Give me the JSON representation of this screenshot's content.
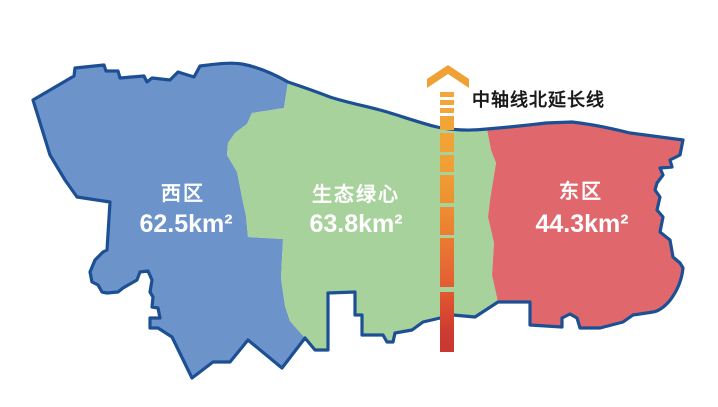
{
  "map": {
    "regions": [
      {
        "id": "west",
        "name": "西区",
        "area": "62.5km²",
        "color": "#6C94CA"
      },
      {
        "id": "green_heart",
        "name": "生态绿心",
        "area": "63.8km²",
        "color": "#A7D29B"
      },
      {
        "id": "east",
        "name": "东区",
        "area": "44.3km²",
        "color": "#E0686D"
      }
    ],
    "axis": {
      "label": "中轴线北延长线",
      "arrow_color": "#F0A136",
      "gradient_top": "#F3A73B",
      "gradient_bottom": "#C93831"
    },
    "colors": {
      "outline": "#1D4F94",
      "region_label_text": "#FFFFFF",
      "axis_label_text": "#1A1A1A",
      "background": "#FFFFFF"
    }
  }
}
